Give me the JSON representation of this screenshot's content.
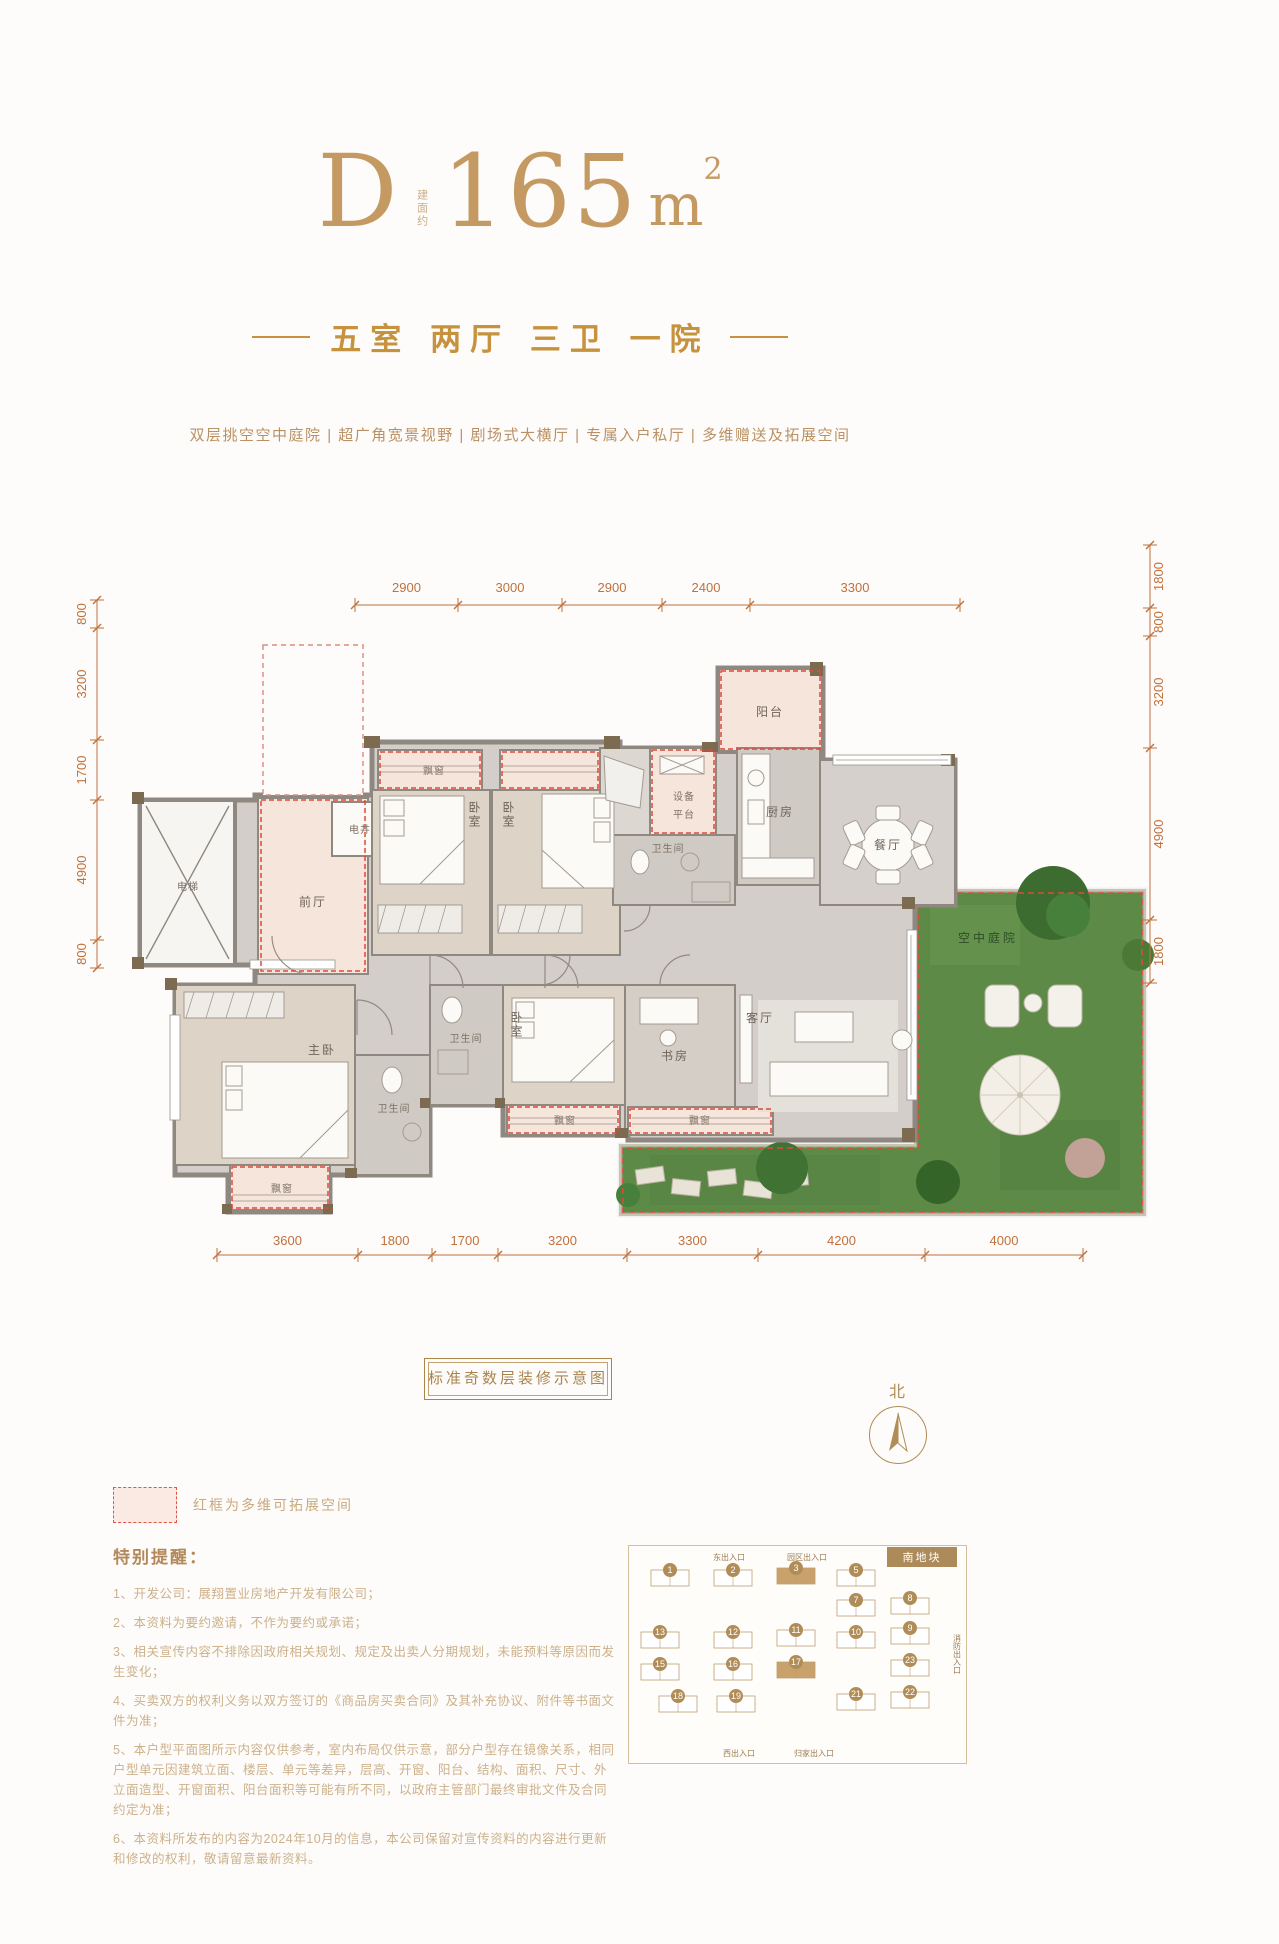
{
  "header": {
    "type_label": "D",
    "area_prefix": "建面约",
    "area_value": "165",
    "area_unit": "m",
    "area_sup": "2",
    "subtitle": "五室 两厅 三卫 一院",
    "features": "双层挑空空中庭院 | 超广角宽景视野 | 剧场式大横厅 | 专属入户私厅 | 多维赠送及拓展空间"
  },
  "floorplan": {
    "rooms": {
      "elevator": "电梯",
      "front_hall": "前厅",
      "shaft": "电井",
      "bay_window": "飘窗",
      "bedroom": "卧室",
      "master_bedroom": "主卧",
      "bathroom": "卫生间",
      "kitchen": "厨房",
      "equipment_l1": "设备",
      "equipment_l2": "平台",
      "balcony": "阳台",
      "dining": "餐厅",
      "living": "客厅",
      "study": "书房",
      "courtyard": "空中庭院"
    },
    "dims": {
      "top": [
        "2900",
        "3000",
        "2900",
        "2400",
        "3300"
      ],
      "left": [
        "800",
        "3200",
        "1700",
        "4900",
        "800"
      ],
      "right": [
        "1800",
        "800",
        "3200",
        "4900",
        "1800"
      ],
      "bottom": [
        "3600",
        "1800",
        "1700",
        "3200",
        "3300",
        "4200",
        "4000"
      ]
    }
  },
  "badge": "标准奇数层装修示意图",
  "north_label": "北",
  "legend_text": "红框为多维可拓展空间",
  "notes": {
    "title": "特别提醒：",
    "items": [
      "1、开发公司：展翔置业房地产开发有限公司；",
      "2、本资料为要约邀请，不作为要约或承诺；",
      "3、相关宣传内容不排除因政府相关规划、规定及出卖人分期规划，未能预料等原因而发生变化；",
      "4、买卖双方的权利义务以双方签订的《商品房买卖合同》及其补充协议、附件等书面文件为准；",
      "5、本户型平面图所示内容仅供参考，室内布局仅供示意，部分户型存在镜像关系，相同户型单元因建筑立面、楼层、单元等差异，层高、开窗、阳台、结构、面积、尺寸、外立面造型、开窗面积、阳台面积等可能有所不同，以政府主管部门最终审批文件及合同约定为准；",
      "6、本资料所发布的内容为2024年10月的信息，本公司保留对宣传资料的内容进行更新和修改的权利，敬请留意最新资料。"
    ]
  },
  "sitemap": {
    "area_label": "南地块",
    "entrances": {
      "top1": "东出入口",
      "top2": "园区出入口",
      "right": "消防出入口",
      "bottom1": "西出入口",
      "bottom2": "归家出入口"
    },
    "buildings": [
      {
        "n": "1",
        "x": 22,
        "y": 24
      },
      {
        "n": "2",
        "x": 85,
        "y": 24
      },
      {
        "n": "3",
        "x": 148,
        "y": 22,
        "hl": true
      },
      {
        "n": "5",
        "x": 208,
        "y": 24
      },
      {
        "n": "7",
        "x": 208,
        "y": 54
      },
      {
        "n": "8",
        "x": 262,
        "y": 52
      },
      {
        "n": "13",
        "x": 12,
        "y": 86
      },
      {
        "n": "12",
        "x": 85,
        "y": 86
      },
      {
        "n": "11",
        "x": 148,
        "y": 84
      },
      {
        "n": "10",
        "x": 208,
        "y": 86
      },
      {
        "n": "9",
        "x": 262,
        "y": 82
      },
      {
        "n": "15",
        "x": 12,
        "y": 118
      },
      {
        "n": "16",
        "x": 85,
        "y": 118
      },
      {
        "n": "17",
        "x": 148,
        "y": 116,
        "hl": true
      },
      {
        "n": "23",
        "x": 262,
        "y": 114
      },
      {
        "n": "18",
        "x": 30,
        "y": 150
      },
      {
        "n": "19",
        "x": 88,
        "y": 150
      },
      {
        "n": "21",
        "x": 208,
        "y": 148
      },
      {
        "n": "22",
        "x": 262,
        "y": 146
      }
    ]
  }
}
